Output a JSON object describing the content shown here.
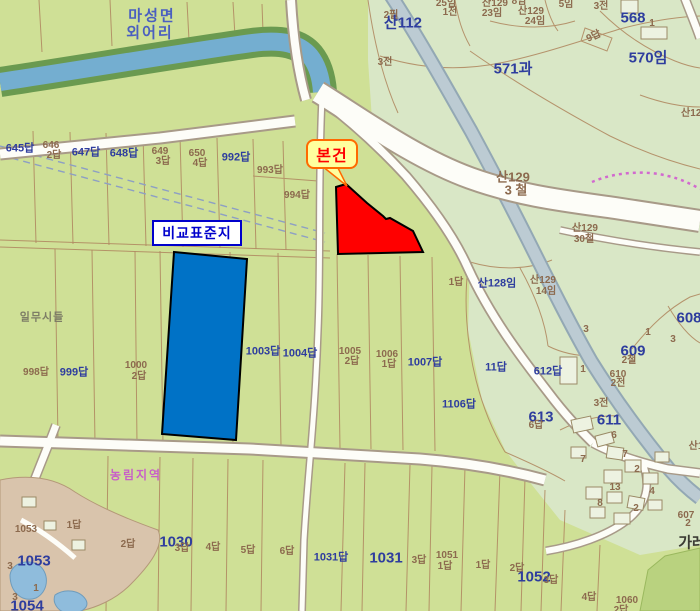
{
  "map": {
    "callouts": {
      "subject": {
        "label": "본건"
      },
      "comparison": {
        "label": "비교표준지"
      }
    },
    "colors": {
      "paddy": "#cfe096",
      "forest": "#d9e7c6",
      "subject_parcel": "#ff0000",
      "comparison_parcel": "#0072c6",
      "callout_subject_bg": "#ffff9e",
      "callout_subject_border": "#ff6a00",
      "callout_subject_text": "#ff0000",
      "callout_comparison_border": "#0000cc",
      "label_blue": "#2e3d9e",
      "label_brown": "#8c6a4e",
      "zone_label_pink": "#c85fc8"
    },
    "labels": [
      {
        "t": "마성면",
        "x": 152,
        "y": 16,
        "c": "t"
      },
      {
        "t": "외어리",
        "x": 150,
        "y": 33,
        "c": "t"
      },
      {
        "t": "2필",
        "x": 391,
        "y": 16,
        "c": "n"
      },
      {
        "t": "산112",
        "x": 403,
        "y": 23,
        "c": "B"
      },
      {
        "t": "25임",
        "x": 446,
        "y": 4,
        "c": "n"
      },
      {
        "t": "1전",
        "x": 450,
        "y": 13,
        "c": "n"
      },
      {
        "t": "8임",
        "x": 519,
        "y": 2,
        "c": "n"
      },
      {
        "t": "산129",
        "x": 495,
        "y": 4,
        "c": "n"
      },
      {
        "t": "23임",
        "x": 492,
        "y": 14,
        "c": "n"
      },
      {
        "t": "산129",
        "x": 531,
        "y": 12,
        "c": "n"
      },
      {
        "t": "24임",
        "x": 535,
        "y": 22,
        "c": "n"
      },
      {
        "t": "5임",
        "x": 566,
        "y": 5,
        "c": "n"
      },
      {
        "t": "3전",
        "x": 601,
        "y": 7,
        "c": "n"
      },
      {
        "t": "1",
        "x": 652,
        "y": 24,
        "c": "n"
      },
      {
        "t": "568",
        "x": 633,
        "y": 18,
        "c": "B"
      },
      {
        "t": "9답",
        "x": 594,
        "y": 37,
        "c": "n",
        "r": -25
      },
      {
        "t": "570임",
        "x": 648,
        "y": 58,
        "c": "B"
      },
      {
        "t": "571과",
        "x": 513,
        "y": 69,
        "c": "B"
      },
      {
        "t": "3전",
        "x": 385,
        "y": 63,
        "c": "n"
      },
      {
        "t": "645답",
        "x": 20,
        "y": 149,
        "c": "b"
      },
      {
        "t": "646",
        "x": 51,
        "y": 146,
        "c": "n"
      },
      {
        "t": "2답",
        "x": 54,
        "y": 156,
        "c": "n"
      },
      {
        "t": "647답",
        "x": 86,
        "y": 153,
        "c": "b"
      },
      {
        "t": "648답",
        "x": 124,
        "y": 154,
        "c": "b"
      },
      {
        "t": "649",
        "x": 160,
        "y": 152,
        "c": "n"
      },
      {
        "t": "3답",
        "x": 163,
        "y": 162,
        "c": "n"
      },
      {
        "t": "650",
        "x": 197,
        "y": 154,
        "c": "n"
      },
      {
        "t": "4답",
        "x": 200,
        "y": 164,
        "c": "n"
      },
      {
        "t": "992답",
        "x": 236,
        "y": 158,
        "c": "b"
      },
      {
        "t": "993답",
        "x": 270,
        "y": 171,
        "c": "n"
      },
      {
        "t": "994답",
        "x": 297,
        "y": 196,
        "c": "n"
      },
      {
        "t": "산129",
        "x": 513,
        "y": 177,
        "c": "N"
      },
      {
        "t": "3 철",
        "x": 516,
        "y": 190,
        "c": "N"
      },
      {
        "t": "산129",
        "x": 694,
        "y": 114,
        "c": "n"
      },
      {
        "t": "산129",
        "x": 585,
        "y": 229,
        "c": "n"
      },
      {
        "t": "30철",
        "x": 584,
        "y": 240,
        "c": "n"
      },
      {
        "t": "산129",
        "x": 543,
        "y": 281,
        "c": "n"
      },
      {
        "t": "14임",
        "x": 546,
        "y": 292,
        "c": "n"
      },
      {
        "t": "1답",
        "x": 456,
        "y": 283,
        "c": "n"
      },
      {
        "t": "산128임",
        "x": 497,
        "y": 284,
        "c": "b"
      },
      {
        "t": "일무시들",
        "x": 42,
        "y": 318,
        "c": "g"
      },
      {
        "t": "998답",
        "x": 36,
        "y": 373,
        "c": "n"
      },
      {
        "t": "999답",
        "x": 74,
        "y": 373,
        "c": "b"
      },
      {
        "t": "1000",
        "x": 136,
        "y": 366,
        "c": "n"
      },
      {
        "t": "2답",
        "x": 139,
        "y": 377,
        "c": "n"
      },
      {
        "t": "1003답",
        "x": 263,
        "y": 352,
        "c": "b"
      },
      {
        "t": "1004답",
        "x": 300,
        "y": 354,
        "c": "b"
      },
      {
        "t": "1005",
        "x": 350,
        "y": 352,
        "c": "n"
      },
      {
        "t": "2답",
        "x": 352,
        "y": 362,
        "c": "n"
      },
      {
        "t": "1006",
        "x": 387,
        "y": 355,
        "c": "n"
      },
      {
        "t": "1답",
        "x": 389,
        "y": 365,
        "c": "n"
      },
      {
        "t": "1007답",
        "x": 425,
        "y": 363,
        "c": "b"
      },
      {
        "t": "1106답",
        "x": 459,
        "y": 405,
        "c": "b"
      },
      {
        "t": "608",
        "x": 689,
        "y": 318,
        "c": "B"
      },
      {
        "t": "609",
        "x": 633,
        "y": 351,
        "c": "B"
      },
      {
        "t": "2철",
        "x": 629,
        "y": 361,
        "c": "n"
      },
      {
        "t": "3",
        "x": 586,
        "y": 330,
        "c": "n"
      },
      {
        "t": "1",
        "x": 648,
        "y": 333,
        "c": "n"
      },
      {
        "t": "3",
        "x": 673,
        "y": 340,
        "c": "n"
      },
      {
        "t": "11답",
        "x": 496,
        "y": 368,
        "c": "b"
      },
      {
        "t": "612답",
        "x": 548,
        "y": 372,
        "c": "b"
      },
      {
        "t": "1",
        "x": 583,
        "y": 370,
        "c": "n"
      },
      {
        "t": "610",
        "x": 618,
        "y": 375,
        "c": "n"
      },
      {
        "t": "2전",
        "x": 618,
        "y": 384,
        "c": "n"
      },
      {
        "t": "3전",
        "x": 601,
        "y": 404,
        "c": "n"
      },
      {
        "t": "613",
        "x": 541,
        "y": 417,
        "c": "B"
      },
      {
        "t": "6답",
        "x": 536,
        "y": 426,
        "c": "n"
      },
      {
        "t": "611",
        "x": 609,
        "y": 420,
        "c": "B"
      },
      {
        "t": "6",
        "x": 614,
        "y": 436,
        "c": "n"
      },
      {
        "t": "7",
        "x": 583,
        "y": 460,
        "c": "n"
      },
      {
        "t": "7",
        "x": 625,
        "y": 455,
        "c": "n"
      },
      {
        "t": "산1",
        "x": 696,
        "y": 447,
        "c": "n"
      },
      {
        "t": "2",
        "x": 637,
        "y": 470,
        "c": "n"
      },
      {
        "t": "13",
        "x": 615,
        "y": 488,
        "c": "n"
      },
      {
        "t": "4",
        "x": 652,
        "y": 492,
        "c": "n"
      },
      {
        "t": "8",
        "x": 600,
        "y": 504,
        "c": "n"
      },
      {
        "t": "2",
        "x": 636,
        "y": 509,
        "c": "n"
      },
      {
        "t": "607",
        "x": 686,
        "y": 516,
        "c": "n"
      },
      {
        "t": "2",
        "x": 688,
        "y": 524,
        "c": "n"
      },
      {
        "t": "가레",
        "x": 692,
        "y": 543,
        "c": "d"
      },
      {
        "t": "농림지역",
        "x": 136,
        "y": 475,
        "c": "p"
      },
      {
        "t": "1답",
        "x": 74,
        "y": 526,
        "c": "n"
      },
      {
        "t": "2답",
        "x": 128,
        "y": 545,
        "c": "n"
      },
      {
        "t": "1030",
        "x": 176,
        "y": 542,
        "c": "B"
      },
      {
        "t": "3답",
        "x": 182,
        "y": 549,
        "c": "n"
      },
      {
        "t": "4답",
        "x": 213,
        "y": 548,
        "c": "n"
      },
      {
        "t": "5답",
        "x": 248,
        "y": 551,
        "c": "n"
      },
      {
        "t": "6답",
        "x": 287,
        "y": 552,
        "c": "n"
      },
      {
        "t": "1031답",
        "x": 331,
        "y": 558,
        "c": "b"
      },
      {
        "t": "1031",
        "x": 386,
        "y": 558,
        "c": "B"
      },
      {
        "t": "3답",
        "x": 419,
        "y": 561,
        "c": "n"
      },
      {
        "t": "1051",
        "x": 447,
        "y": 556,
        "c": "n"
      },
      {
        "t": "1답",
        "x": 445,
        "y": 567,
        "c": "n"
      },
      {
        "t": "1답",
        "x": 483,
        "y": 566,
        "c": "n"
      },
      {
        "t": "2답",
        "x": 517,
        "y": 569,
        "c": "n"
      },
      {
        "t": "1052",
        "x": 534,
        "y": 577,
        "c": "B"
      },
      {
        "t": "3답",
        "x": 551,
        "y": 581,
        "c": "n"
      },
      {
        "t": "4답",
        "x": 589,
        "y": 598,
        "c": "n"
      },
      {
        "t": "1060",
        "x": 627,
        "y": 601,
        "c": "n"
      },
      {
        "t": "2답",
        "x": 621,
        "y": 611,
        "c": "n"
      },
      {
        "t": "1053",
        "x": 26,
        "y": 530,
        "c": "n"
      },
      {
        "t": "1053",
        "x": 34,
        "y": 561,
        "c": "B"
      },
      {
        "t": "3",
        "x": 10,
        "y": 567,
        "c": "n"
      },
      {
        "t": "1",
        "x": 36,
        "y": 589,
        "c": "n"
      },
      {
        "t": "3",
        "x": 15,
        "y": 598,
        "c": "n"
      },
      {
        "t": "1054",
        "x": 27,
        "y": 606,
        "c": "B"
      }
    ]
  }
}
